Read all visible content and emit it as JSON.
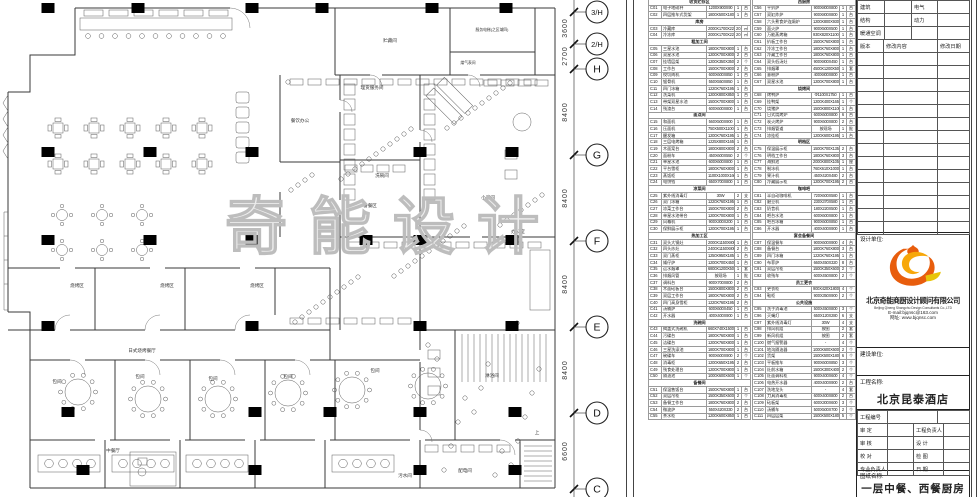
{
  "watermark": "奇能设计",
  "plan": {
    "labels": [
      {
        "t": "贮藏间",
        "x": 390,
        "y": 42
      },
      {
        "t": "服务电梯(之区域四)",
        "x": 492,
        "y": 31,
        "s": 3.8
      },
      {
        "t": "煤气表间",
        "x": 468,
        "y": 64,
        "s": 3.8
      },
      {
        "t": "理货服务间",
        "x": 372,
        "y": 89
      },
      {
        "t": "餐饮办公",
        "x": 300,
        "y": 122
      },
      {
        "t": "洗碗间",
        "x": 382,
        "y": 177
      },
      {
        "t": "备餐区",
        "x": 370,
        "y": 207
      },
      {
        "t": "小酒间",
        "x": 488,
        "y": 199
      },
      {
        "t": "办公室",
        "x": 518,
        "y": 233
      },
      {
        "t": "烧烤区",
        "x": 77,
        "y": 287
      },
      {
        "t": "烧烤区",
        "x": 167,
        "y": 287
      },
      {
        "t": "烧烤区",
        "x": 257,
        "y": 287
      },
      {
        "t": "日式烧烤餐厅",
        "x": 142,
        "y": 352
      },
      {
        "t": "包间",
        "x": 57,
        "y": 383
      },
      {
        "t": "包间",
        "x": 140,
        "y": 378
      },
      {
        "t": "包间",
        "x": 213,
        "y": 380
      },
      {
        "t": "包间",
        "x": 288,
        "y": 378
      },
      {
        "t": "包间",
        "x": 375,
        "y": 372
      },
      {
        "t": "淋浴间",
        "x": 492,
        "y": 377
      },
      {
        "t": "中餐厅",
        "x": 113,
        "y": 452
      },
      {
        "t": "配电间",
        "x": 465,
        "y": 472
      },
      {
        "t": "污水间",
        "x": 405,
        "y": 477
      },
      {
        "t": "上",
        "x": 537,
        "y": 434
      }
    ]
  },
  "grid": {
    "bubbles": [
      {
        "label": "3/H",
        "y": 12
      },
      {
        "label": "2/H",
        "y": 44
      },
      {
        "label": "H",
        "y": 69
      },
      {
        "label": "G",
        "y": 155
      },
      {
        "label": "F",
        "y": 241
      },
      {
        "label": "E",
        "y": 327
      },
      {
        "label": "D",
        "y": 413
      },
      {
        "label": "C",
        "y": 489
      }
    ],
    "dims": [
      {
        "text": "3600",
        "y": 28
      },
      {
        "text": "2700",
        "y": 56
      },
      {
        "text": "8400",
        "y": 112
      },
      {
        "text": "8400",
        "y": 198
      },
      {
        "text": "8400",
        "y": 284
      },
      {
        "text": "8400",
        "y": 370
      },
      {
        "text": "6600",
        "y": 451
      }
    ]
  },
  "tables": {
    "t1_rows": [
      {
        "g": "收货贮存区"
      },
      [
        "C01",
        "电子地磅秤",
        "1200X900X90",
        "1",
        "台"
      ],
      [
        "C02",
        "四层推车式货架",
        "1800X500X1800",
        "1",
        "台"
      ],
      {
        "g": "库房"
      },
      [
        "C03",
        "冷藏库",
        "2000X1700X2200",
        "20.6",
        "㎡"
      ],
      [
        "C04",
        "冷冻库",
        "2000X1700X2200",
        "20.6",
        "㎡"
      ],
      {
        "g": "粗加工间"
      },
      [
        "C05",
        "三星水池",
        "1800X700X800",
        "1",
        "台"
      ],
      [
        "C06",
        "双星水池",
        "1200X700X800",
        "2",
        "台"
      ],
      [
        "C07",
        "挂墙层架",
        "1200X350X350",
        "2",
        "个"
      ],
      [
        "C08",
        "工作台",
        "1500X700X800",
        "2",
        "台"
      ],
      [
        "C09",
        "绞切肉机",
        "600X600X850",
        "1",
        "台"
      ],
      [
        "C10",
        "锯骨机",
        "550X550X850",
        "1",
        "台"
      ],
      [
        "C11",
        "四门冰箱",
        "1220X760X1950",
        "1",
        "台"
      ],
      [
        "C12",
        "洗菜机",
        "1200X800X850",
        "1",
        "台"
      ],
      [
        "C13",
        "带架双星水池",
        "1500X700X800",
        "1",
        "台"
      ],
      [
        "C14",
        "残渣台",
        "600X600X800",
        "1",
        "台"
      ],
      {
        "g": "面点间"
      },
      [
        "C15",
        "和面机",
        "560X500X900",
        "1",
        "台"
      ],
      [
        "C16",
        "压面机",
        "750X500X1100",
        "1",
        "台"
      ],
      [
        "C17",
        "醒发箱",
        "1200X760X1950",
        "1",
        "台"
      ],
      [
        "C18",
        "三层电烤箱",
        "1225X800X1650",
        "1",
        "台"
      ],
      [
        "C19",
        "木面案台",
        "1800X800X800",
        "2",
        "台"
      ],
      [
        "C20",
        "面粉车",
        "450X600X550",
        "2",
        "个"
      ],
      [
        "C21",
        "单星水池",
        "600X600X800",
        "1",
        "台"
      ],
      [
        "C22",
        "平台雪柜",
        "1800X760X800",
        "1",
        "台"
      ],
      [
        "C23",
        "蒸饭柜",
        "1100X1000X1600",
        "1",
        "台"
      ],
      [
        "C24",
        "电饼铛",
        "650X700X800",
        "1",
        "台"
      ],
      {
        "g": "凉菜间"
      },
      [
        "C25",
        "紫外线消毒灯",
        "30W",
        "2",
        "支"
      ],
      [
        "C26",
        "双门冰箱",
        "1220X760X1950",
        "1",
        "台"
      ],
      [
        "C27",
        "凉菜工作台",
        "1500X700X800",
        "2",
        "台"
      ],
      [
        "C28",
        "单星水池带台",
        "1200X700X800",
        "1",
        "台"
      ],
      [
        "C29",
        "风幕机",
        "900X300X200",
        "1",
        "台"
      ],
      [
        "C30",
        "保鲜展示柜",
        "1200X700X1950",
        "1",
        "台"
      ],
      {
        "g": "热加工区"
      },
      [
        "C31",
        "双头大锅灶",
        "2000X1150X800",
        "1",
        "台"
      ],
      [
        "C32",
        "四头炒灶",
        "2400X1150X800",
        "2",
        "台"
      ],
      [
        "C33",
        "双门蒸柜",
        "1250X950X1850",
        "1",
        "台"
      ],
      [
        "C34",
        "矮仔炉",
        "1200X700X450",
        "1",
        "台"
      ],
      [
        "C35",
        "运水烟罩",
        "6800X1200X500",
        "1",
        "套"
      ],
      [
        "C36",
        "排烟风管",
        "按现场",
        "1",
        "批"
      ],
      [
        "C37",
        "调料台",
        "900X700X800",
        "2",
        "台"
      ],
      [
        "C38",
        "木面砧板台",
        "1500X800X800",
        "2",
        "台"
      ],
      [
        "C39",
        "双层工作台",
        "1800X760X800",
        "2",
        "台"
      ],
      [
        "C40",
        "四门高身雪柜",
        "1220X760X1950",
        "2",
        "台"
      ],
      [
        "C41",
        "汤桶炉",
        "600X600X450",
        "1",
        "台"
      ],
      [
        "C42",
        "开水器",
        "400X400X900",
        "1",
        "台"
      ],
      {
        "g": "洗碗间"
      },
      [
        "C43",
        "揭盖式洗碗机",
        "660X740X1500",
        "1",
        "台"
      ],
      [
        "C44",
        "污碟台",
        "1800X760X800",
        "1",
        "台"
      ],
      [
        "C45",
        "洁碟台",
        "1200X760X800",
        "1",
        "台"
      ],
      [
        "C46",
        "三星洗涤池",
        "1800X700X800",
        "1",
        "台"
      ],
      [
        "C47",
        "碗碟车",
        "900X600X900",
        "2",
        "个"
      ],
      [
        "C48",
        "消毒柜",
        "1200X650X1950",
        "2",
        "台"
      ],
      [
        "C49",
        "残食处理台",
        "1200X700X800",
        "1",
        "台"
      ],
      [
        "C50",
        "隔油池",
        "1000X600X600",
        "1",
        "个"
      ],
      {
        "g": "备餐间"
      },
      [
        "C51",
        "保温售饭台",
        "1500X760X800",
        "1",
        "台"
      ],
      [
        "C52",
        "双层吊柜",
        "1500X350X600",
        "2",
        "个"
      ],
      [
        "C53",
        "备餐工作台",
        "1800X760X800",
        "2",
        "台"
      ],
      [
        "C54",
        "微波炉",
        "550X420X330",
        "2",
        "台"
      ],
      [
        "C55",
        "茶水柜",
        "1200X600X850",
        "1",
        "台"
      ]
    ],
    "t2_rows": [
      {
        "g": "西厨房"
      },
      [
        "C56",
        "平扒炉",
        "900X800X800",
        "1",
        "台"
      ],
      [
        "C57",
        "双缸炸炉",
        "900X800X800",
        "1",
        "台"
      ],
      [
        "C58",
        "六头煮食炉连焗炉",
        "1200X800X930",
        "1",
        "台"
      ],
      [
        "C59",
        "面火炉",
        "900X500X500",
        "1",
        "台"
      ],
      [
        "C60",
        "万能蒸烤箱",
        "930X820X1100",
        "1",
        "台"
      ],
      [
        "C61",
        "扒板工作台",
        "1500X760X800",
        "1",
        "台"
      ],
      [
        "C62",
        "冷冻工作台",
        "1800X760X800",
        "1",
        "台"
      ],
      [
        "C63",
        "冷藏工作台",
        "1800X760X800",
        "1",
        "台"
      ],
      [
        "C64",
        "双头低汤灶",
        "900X800X450",
        "1",
        "台"
      ],
      [
        "C65",
        "排烟罩",
        "4500X1200X500",
        "1",
        "套"
      ],
      [
        "C66",
        "意粉炉",
        "400X800X800",
        "1",
        "台"
      ],
      [
        "C67",
        "双星水池",
        "1200X700X800",
        "1",
        "台"
      ],
      {
        "g": "烧烤间"
      },
      [
        "C68",
        "烤鸭炉",
        "Φ1100X1750",
        "1",
        "台"
      ],
      [
        "C69",
        "挂鸭架",
        "1200X400X1650",
        "1",
        "个"
      ],
      [
        "C70",
        "烧猪炉",
        "1500X800X1100",
        "1",
        "台"
      ],
      [
        "C71",
        "日式烧烤炉",
        "600X600X800",
        "6",
        "台"
      ],
      [
        "C72",
        "炭火烤炉",
        "900X600X800",
        "2",
        "台"
      ],
      [
        "C73",
        "排烟管道",
        "按现场",
        "1",
        "批"
      ],
      [
        "C74",
        "凉挂柜",
        "1200X600X1950",
        "1",
        "台"
      ],
      {
        "g": "明档区"
      },
      [
        "C75",
        "保温展示柜",
        "1500X700X1350",
        "2",
        "台"
      ],
      [
        "C76",
        "明档工作台",
        "1800X760X800",
        "3",
        "台"
      ],
      [
        "C77",
        "海鲜池",
        "2000X800X1050",
        "1",
        "座"
      ],
      [
        "C78",
        "制冰机",
        "760X610X1000",
        "1",
        "台"
      ],
      [
        "C79",
        "果汁机",
        "450X420X480",
        "2",
        "台"
      ],
      [
        "C80",
        "冷藏展示柜",
        "1200X700X1950",
        "2",
        "台"
      ],
      {
        "g": "咖啡吧"
      },
      [
        "C81",
        "半自动咖啡机",
        "720X600X580",
        "1",
        "台"
      ],
      [
        "C82",
        "磨豆机",
        "230X370X580",
        "1",
        "台"
      ],
      [
        "C83",
        "奶昔机",
        "180X220X500",
        "1",
        "台"
      ],
      [
        "C84",
        "吧台水池",
        "600X600X800",
        "1",
        "台"
      ],
      [
        "C85",
        "吧台冰箱",
        "900X600X850",
        "1",
        "台"
      ],
      [
        "C86",
        "开水器",
        "400X400X900",
        "1",
        "台"
      ],
      {
        "g": "宴会备餐间"
      },
      [
        "C87",
        "保温餐车",
        "900X600X900",
        "4",
        "台"
      ],
      [
        "C88",
        "备餐台",
        "1800X760X800",
        "3",
        "台"
      ],
      [
        "C89",
        "四门冰箱",
        "1220X760X1950",
        "1",
        "台"
      ],
      [
        "C90",
        "布菲炉",
        "660X450X320",
        "8",
        "台"
      ],
      [
        "C91",
        "双层吊柜",
        "1500X350X600",
        "2",
        "个"
      ],
      [
        "C92",
        "收残车",
        "600X450X800",
        "2",
        "个"
      ],
      {
        "g": "员工更衣"
      },
      [
        "C93",
        "更衣柜",
        "900X420X1800",
        "4",
        "个"
      ],
      [
        "C94",
        "鞋柜",
        "900X350X900",
        "2",
        "个"
      ],
      {
        "g": "公共设施"
      },
      [
        "C95",
        "洗手消毒池",
        "500X450X800",
        "3",
        "个"
      ],
      [
        "C96",
        "灭蝇灯",
        "650X120X280",
        "6",
        "支"
      ],
      [
        "C97",
        "紫外线消毒灯",
        "30W",
        "4",
        "支"
      ],
      [
        "C98",
        "排风机组",
        "按图",
        "2",
        "套"
      ],
      [
        "C99",
        "新风机组",
        "按图",
        "2",
        "套"
      ],
      [
        "C100",
        "燃气报警器",
        "-",
        "4",
        "个"
      ],
      [
        "C101",
        "地沟隔油器",
        "1000X600X600",
        "2",
        "个"
      ],
      [
        "C102",
        "货架",
        "1500X500X1800",
        "6",
        "个"
      ],
      [
        "C103",
        "平板推车",
        "900X600X850",
        "3",
        "个"
      ],
      [
        "C104",
        "灶前水箱",
        "1500X300X400",
        "2",
        "个"
      ],
      [
        "C105",
        "灶面调料柜",
        "900X400X600",
        "4",
        "个"
      ],
      [
        "C106",
        "电热开水器",
        "400X400X900",
        "2",
        "台"
      ],
      [
        "C107",
        "洗地龙头",
        "-",
        "4",
        "套"
      ],
      [
        "C108",
        "刀具消毒柜",
        "600X400X800",
        "2",
        "台"
      ],
      [
        "C109",
        "砧板架",
        "600X300X600",
        "3",
        "个"
      ],
      [
        "C110",
        "汤桶车",
        "500X500X700",
        "2",
        "个"
      ],
      [
        "C111",
        "四层层架",
        "1500X500X1800",
        "5",
        "个"
      ]
    ]
  },
  "titleblock": {
    "disciplines": [
      [
        "建筑",
        "",
        "电气",
        ""
      ],
      [
        "结构",
        "",
        "动力",
        ""
      ],
      [
        "暖通空调",
        "",
        "",
        ""
      ]
    ],
    "rev_headers": [
      "版本",
      "修改内容",
      "修改日期"
    ],
    "design_unit_label": "设计单位:",
    "company_cn": "北京奇能商厨设计顾问有限公司",
    "company_en": "Beijing Qineng Shangchu Design Consultants Co.,LTD",
    "email": "E-mail:bjqnsc@163.com",
    "website": "网址: www.bjqnsc.com",
    "client_label": "建设单位:",
    "project_label": "工程名称:",
    "project_name": "北京昆泰酒店",
    "project_no_label": "工程编号",
    "sign_rows": [
      [
        "审 定",
        "工程负责人"
      ],
      [
        "审 核",
        "设 计"
      ],
      [
        "校 对",
        "检 图"
      ],
      [
        "专业负责人",
        "日 期"
      ]
    ],
    "sheet_label": "图纸名称:",
    "sheet_title": "一层中餐、西餐厨房",
    "logo_colors": {
      "orange": "#e85d0d",
      "yellow": "#f7a70a",
      "gold": "#e8c50a"
    }
  }
}
